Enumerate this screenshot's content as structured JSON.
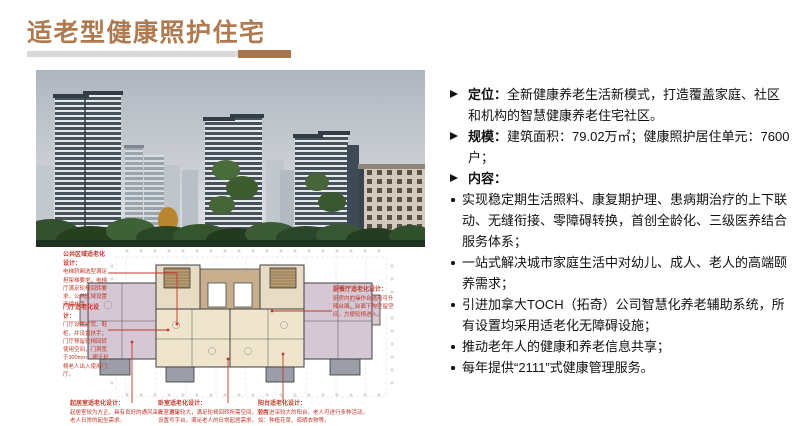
{
  "title": {
    "text": "适老型健康照护住宅"
  },
  "colors": {
    "accent_brown": "#b07a50",
    "accent_bar_brown": "#a8764c",
    "bar_gray": "#d9d9d9",
    "annotation_red": "#c0392b",
    "body_text": "#111111"
  },
  "content": {
    "items": [
      {
        "bullet": "arrow",
        "label": "定位：",
        "text": "全新健康养老生活新模式，打造覆盖家庭、社区和机构的智慧健康养老住宅社区。"
      },
      {
        "bullet": "arrow",
        "label": "规模：",
        "text": "建筑面积：79.02万㎡；健康照护居住单元：7600户；"
      },
      {
        "bullet": "arrow",
        "label": "内容：",
        "text": ""
      },
      {
        "bullet": "dot",
        "text": "实现稳定期生活照料、康复期护理、患病期治疗的上下联动、无缝衔接、零障碍转换，首创全龄化、三级医养结合服务体系；"
      },
      {
        "bullet": "dot",
        "text": "一站式解决城市家庭生活中对幼儿、成人、老人的高端颐养需求；"
      },
      {
        "bullet": "dot",
        "text": "引进加拿大TOCH（拓奇）公司智慧化养老辅助系统，所有设置均采用适老化无障碍设施；"
      },
      {
        "bullet": "dot",
        "text": "推动老年人的健康和养老信息共享；"
      },
      {
        "bullet": "dot",
        "text": "每年提供“2111”式健康管理服务。"
      }
    ]
  },
  "floor_plan": {
    "annotations": {
      "public_area": {
        "title": "公共区域适老化设计：",
        "body": "电梯轿厢选型满足担架梯要求，电梯厅满足轮椅回转要求，公共区域设置连续扶手。"
      },
      "lobby": {
        "title": "门厅适老化设计：",
        "body": "门厅设置坐凳、鞋柜，并设置扶手；门厅预留轮椅回转使用空间，门洞宽于300mm，便于轮椅老人出入使用门厅。"
      },
      "kitchen": {
        "title": "厨餐厅适老化设计：",
        "body": "厨房内的操作台选用可升降台面，台面下掏空留空间，方便轮椅进入。"
      },
      "living": {
        "title": "起居室适老化设计：",
        "body": "起居室较为方正，具有良好的通风采光，满足老人日常的起坐需求。"
      },
      "bedroom": {
        "title": "卧室适老化设计：",
        "body": "卧室进深较大，满足轮椅回转所需空间，室内设置写字台，满足老人的日常起居需求。"
      },
      "balcony": {
        "title": "阳台适老化设计：",
        "body": "设置进深较大的阳台，老人可进行多种活动，如：种植花草、晾晒衣物等。"
      }
    }
  }
}
